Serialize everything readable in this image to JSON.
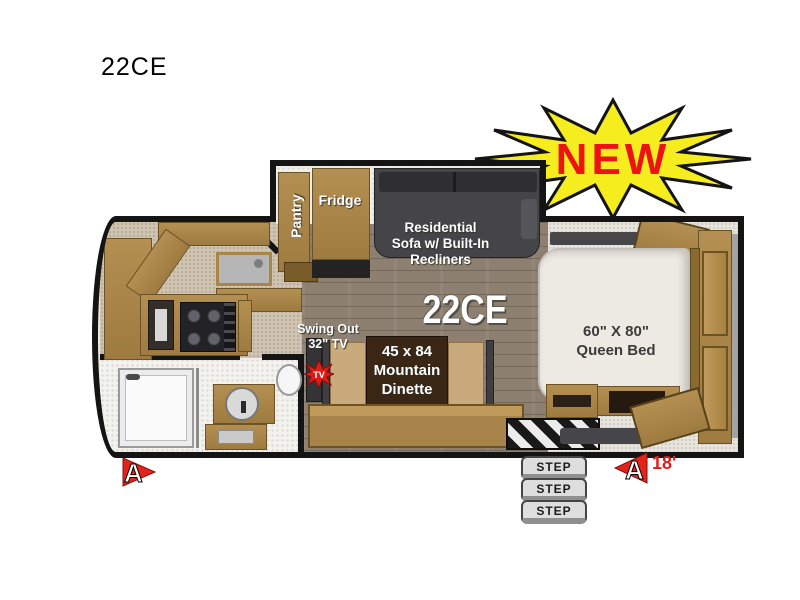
{
  "title": "22CE",
  "badge": {
    "label": "NEW",
    "fill": "#f6ed1f",
    "text_color": "#ee1313"
  },
  "floorplan": {
    "model": "22CE",
    "slideout": {
      "pantry": "Pantry",
      "fridge": "Fridge",
      "sofa_line1": "Residential",
      "sofa_line2": "Sofa w/ Built-In",
      "sofa_line3": "Recliners"
    },
    "tv": {
      "line1": "Swing Out",
      "line2": "32\" TV",
      "icon": "TV"
    },
    "dinette": {
      "line1": "45 x 84",
      "line2": "Mountain",
      "line3": "Dinette"
    },
    "bed": {
      "line1": "60\" X 80\"",
      "line2": "Queen Bed"
    },
    "steps": [
      "STEP",
      "STEP",
      "STEP"
    ],
    "markers": {
      "front": "A",
      "rear": "A",
      "length": "18'"
    }
  },
  "colors": {
    "wall": "#141414",
    "wood": "#a8834a",
    "dark_furniture": "#3f3f43",
    "accent_red": "#e31d1a"
  }
}
